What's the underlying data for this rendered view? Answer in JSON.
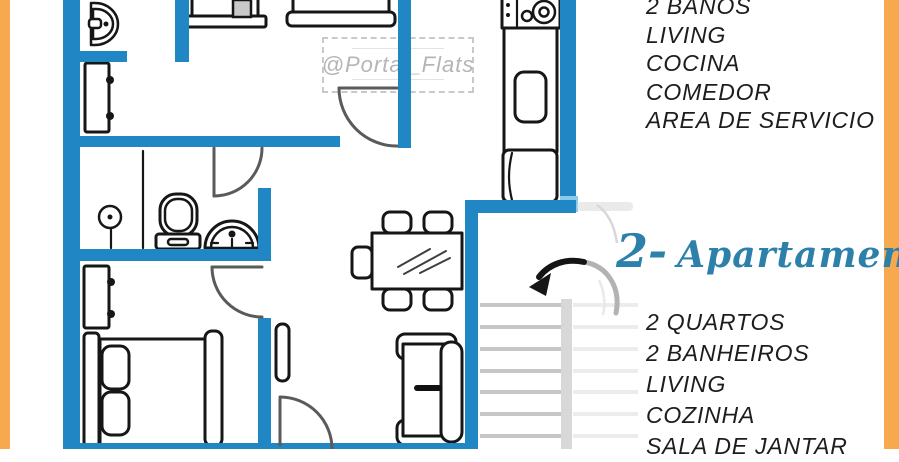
{
  "colors": {
    "accent_orange": "#f6a94e",
    "wall_blue": "#2187c4",
    "wall_blue_light": "#8ccaea",
    "script_blue": "#2d80aa",
    "text_dark": "#1d1d1b",
    "watermark_gray": "#b5b5b5",
    "stair_gray": "#c6c6c6"
  },
  "watermark": {
    "handle": "@Portal_Flats",
    "decor_dashes": "╌╌╌╌╌╌╌╌╌╌╌╌╌╌╌╌╌╌╌╌╌╌"
  },
  "apartment_1": {
    "features": [
      "2 BAÑOS",
      "LIVING",
      "COCINA",
      "COMEDOR",
      "AREA DE SERVICIO"
    ]
  },
  "apartment_2": {
    "label_number": "2-",
    "label_name": "Apartamento",
    "features": [
      "2 QUARTOS",
      "2 BANHEIROS",
      "LIVING",
      "COZINHA",
      "SALA DE JANTAR"
    ]
  },
  "floor_plan": {
    "elements": [
      "walls",
      "doors",
      "vanity-sink",
      "cabinet",
      "wardrobe",
      "bed-foot",
      "shower",
      "toilet",
      "pedestal-sink",
      "dresser",
      "double-bed",
      "console-shelf",
      "dining-table",
      "chairs",
      "sofa",
      "stove",
      "kitchen-counter-sink",
      "fridge",
      "stairs",
      "curved-arrow"
    ]
  }
}
